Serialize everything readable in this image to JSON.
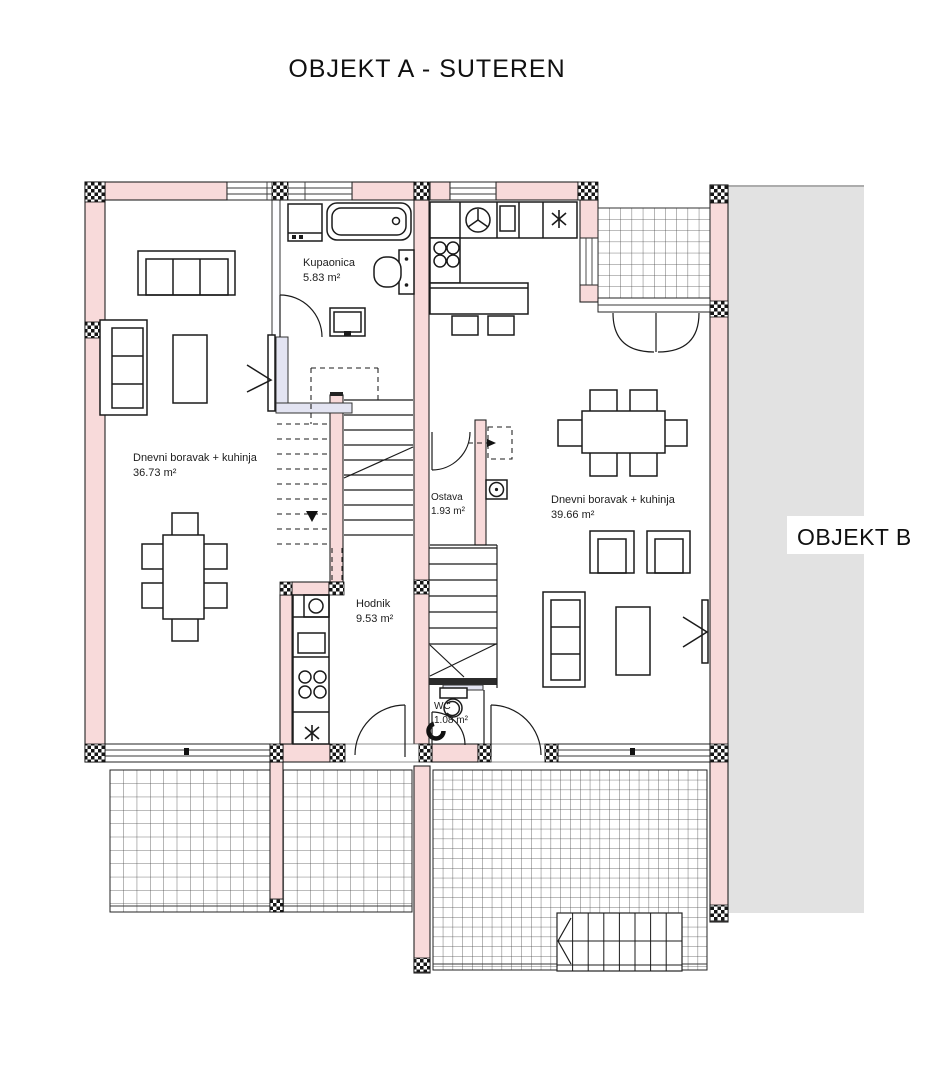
{
  "title": "OBJEKT A - SUTEREN",
  "adjacent_building": {
    "label": "OBJEKT B"
  },
  "rooms": {
    "kupaonica": {
      "name": "Kupaonica",
      "area": "5.83 m²"
    },
    "dnevni_left": {
      "name": "Dnevni boravak + kuhinja",
      "area": "36.73 m²"
    },
    "ostava": {
      "name": "Ostava",
      "area": "1.93 m²"
    },
    "dnevni_right": {
      "name": "Dnevni boravak + kuhinja",
      "area": "39.66 m²"
    },
    "hodnik": {
      "name": "Hodnik",
      "area": "9.53 m²"
    },
    "wc": {
      "name": "WC",
      "area": "1.08 m²"
    }
  },
  "colors": {
    "wall_fill": "#f8dada",
    "glass_fill": "#e3e4f2",
    "adjacent_fill": "#e2e2e2",
    "line": "#1b1b1b"
  }
}
